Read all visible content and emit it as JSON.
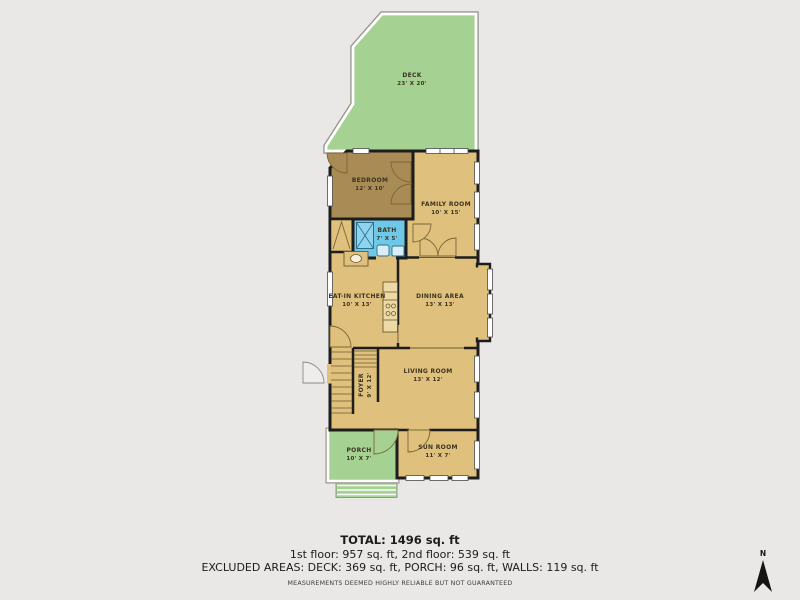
{
  "palette": {
    "background": "#e9e8e6",
    "wall": "#1d1d1d",
    "room_tan": "#dfc07d",
    "room_brown": "#a98c55",
    "room_blue": "#70c8e9",
    "outdoor_green": "#a5d293",
    "label_text": "#3a3420",
    "footer_text": "#1c1c1c"
  },
  "rooms": [
    {
      "id": "deck",
      "name": "DECK",
      "dims": "23' X 20'"
    },
    {
      "id": "bedroom",
      "name": "BEDROOM",
      "dims": "12' X 10'"
    },
    {
      "id": "family-room",
      "name": "FAMILY ROOM",
      "dims": "10' X 15'"
    },
    {
      "id": "bath",
      "name": "BATH",
      "dims": "7' X 5'"
    },
    {
      "id": "eat-in-kitchen",
      "name": "EAT-IN KITCHEN",
      "dims": "10' X 13'"
    },
    {
      "id": "dining-area",
      "name": "DINING AREA",
      "dims": "13' X 13'"
    },
    {
      "id": "foyer",
      "name": "FOYER",
      "dims": "9' X 12'"
    },
    {
      "id": "living-room",
      "name": "LIVING ROOM",
      "dims": "13' X 12'"
    },
    {
      "id": "porch",
      "name": "PORCH",
      "dims": "10' X 7'"
    },
    {
      "id": "sun-room",
      "name": "SUN ROOM",
      "dims": "11' X 7'"
    }
  ],
  "footer": {
    "total": "TOTAL: 1496 sq. ft",
    "floors": "1st floor: 957 sq. ft, 2nd floor: 539 sq. ft",
    "excluded": "EXCLUDED AREAS: DECK: 369 sq. ft, PORCH: 96 sq. ft, WALLS: 119 sq. ft",
    "disclaimer": "MEASUREMENTS DEEMED HIGHLY RELIABLE BUT NOT GUARANTEED"
  },
  "compass": {
    "label": "N"
  }
}
